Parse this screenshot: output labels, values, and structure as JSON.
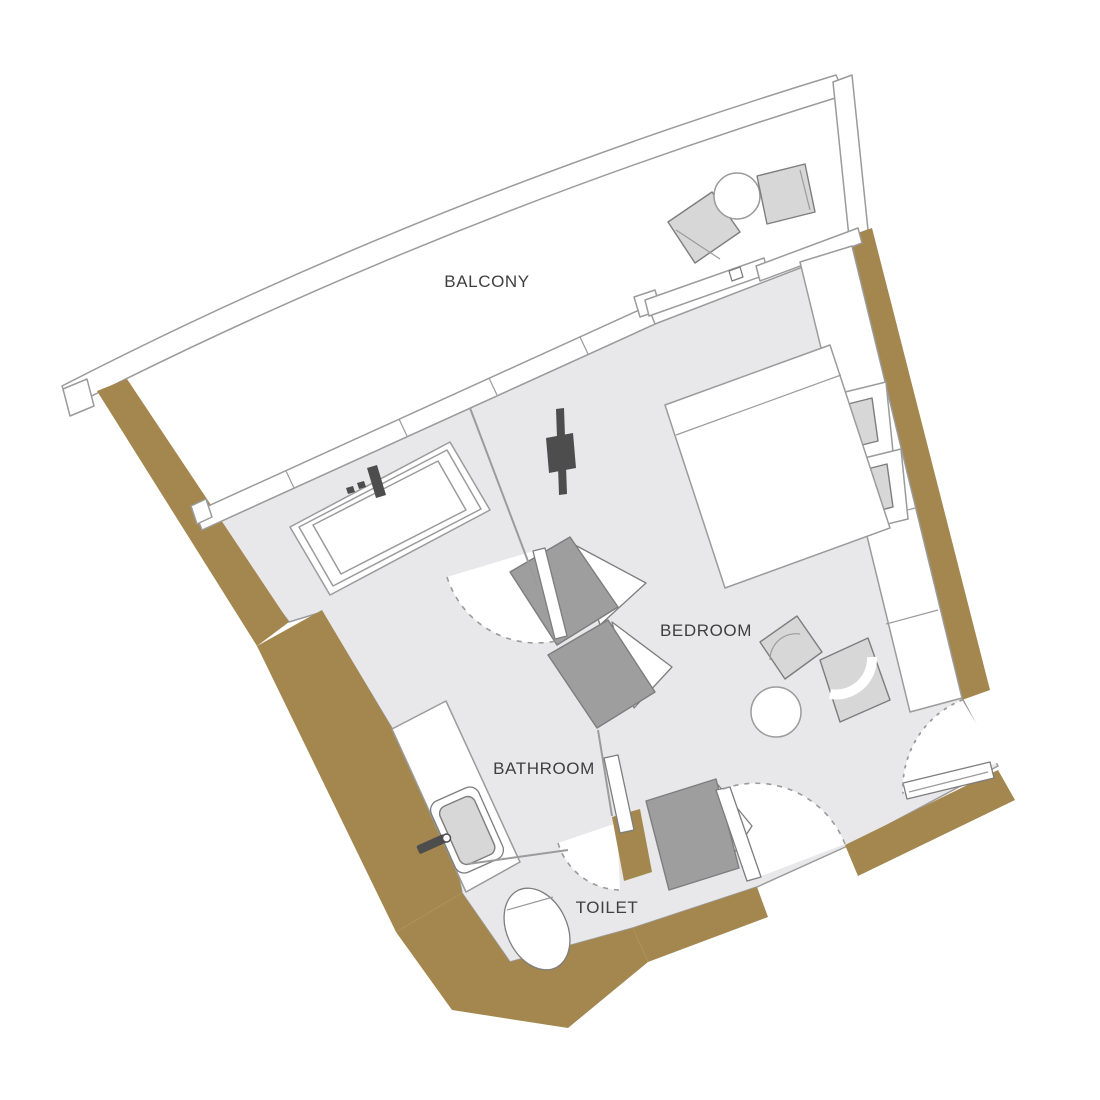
{
  "title": "apartment-floor-plan",
  "labels": {
    "balcony": "BALCONY",
    "bedroom": "BEDROOM",
    "bathroom": "BATHROOM",
    "toilet": "TOILET"
  },
  "colors": {
    "paper": "#ffffff",
    "floor": "#e8e8ea",
    "wall": "#a3874e",
    "outline": "#9b9b9b",
    "outline_dark": "#7d7d7d",
    "furniture": "#d7d7d7",
    "furniture_dark": "#9e9e9e",
    "fixture": "#4d4d4d",
    "text": "#3f3f3f"
  }
}
